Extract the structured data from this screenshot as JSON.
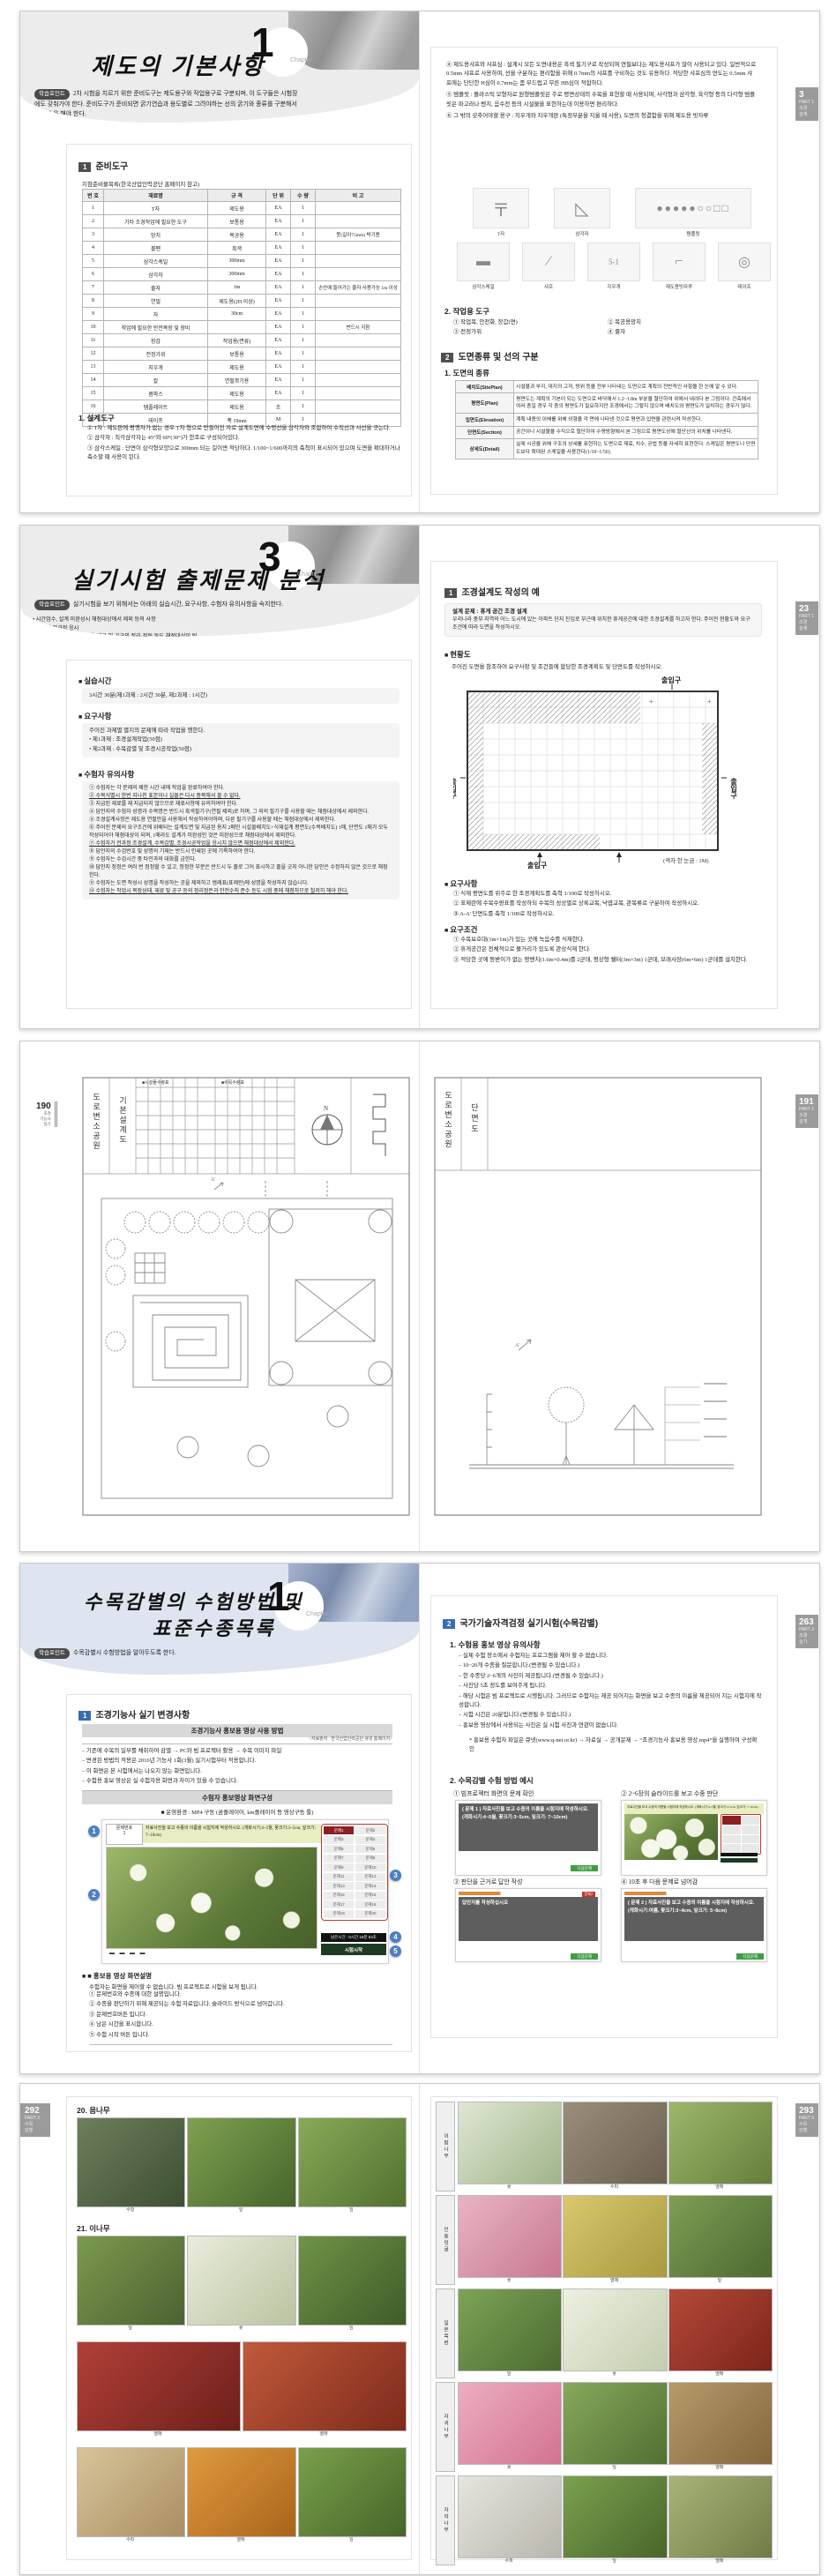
{
  "spread1": {
    "left": {
      "title": "제도의 기본사항",
      "chapter": "1",
      "chapter_word": "Chapter",
      "sp_label": "학습포인트",
      "sp_text": "2차 시험을 치르기 위한 준비도구는 제도용구와 작업용구로 구분되며, 이 도구들은 시험장에도 갖춰가야 한다. 준비도구가 준비되면 굵기연습과 용도별로 그려야하는 선의 굵기와 종류를 구분해서 선 연습을 해야 한다.",
      "sec_num": "1",
      "sec_title": "준비도구",
      "tbl_caption": "지참준비물목록(한국산업인력공단 홈페이지 참고)",
      "headers": [
        "번 호",
        "재료명",
        "규 격",
        "단 위",
        "수 량",
        "비 고"
      ],
      "rows": [
        [
          "1",
          "T자",
          "제도용",
          "EA",
          "1",
          ""
        ],
        [
          "2",
          "기타 조경작업에 필요한 도구",
          "보통용",
          "EA",
          "1",
          ""
        ],
        [
          "3",
          "망치",
          "목공용",
          "EA",
          "1",
          "못(길이75mm) 박기용"
        ],
        [
          "4",
          "볼펜",
          "흑색",
          "EA",
          "1",
          ""
        ],
        [
          "5",
          "삼각스케일",
          "300mm",
          "EA",
          "1",
          ""
        ],
        [
          "6",
          "삼각자",
          "300mm",
          "EA",
          "1",
          ""
        ],
        [
          "7",
          "줄자",
          "1m",
          "EA",
          "1",
          "손안에 들어가는 줄자 사용가능 1m 이상"
        ],
        [
          "8",
          "연필",
          "제도용(2H 이상)",
          "EA",
          "1",
          ""
        ],
        [
          "9",
          "자",
          "30cm",
          "EA",
          "1",
          ""
        ],
        [
          "10",
          "작업에 필요한 안전복장 및 장비",
          "",
          "EA",
          "1",
          "반드시 지참"
        ],
        [
          "11",
          "장갑",
          "작업용(면류)",
          "EA",
          "1",
          ""
        ],
        [
          "12",
          "전정가위",
          "보통용",
          "EA",
          "1",
          ""
        ],
        [
          "13",
          "지우개",
          "제도용",
          "EA",
          "1",
          ""
        ],
        [
          "14",
          "칼",
          "연필깎기용",
          "EA",
          "1",
          ""
        ],
        [
          "15",
          "콤파스",
          "제도용",
          "EA",
          "1",
          ""
        ],
        [
          "16",
          "템플레이트",
          "제도용",
          "조",
          "1",
          ""
        ],
        [
          "17",
          "테이프",
          "폭 19mm",
          "M",
          "1",
          ""
        ]
      ],
      "sub_title": "1. 설계도구",
      "notes": [
        "① T자 : 제도판에 평행자가 없는 경우 T자 형으로 만들어진 자로 설계도면에 수평선을 삼각자와 조합하여 수직선과 사선을 긋는다.",
        "② 삼각자 : 직각삼각자는 45°와 60°(30°)가 한조로 구성되어있다.",
        "③ 삼각스케일 : 단면이 삼각형모양으로 300mm 되는 길이면 적당하다. 1/100~1/600까지의 축척이 표시되어 있으며 도면을 확대하거나 축소할 때 사용이 된다."
      ]
    },
    "right": {
      "paras": [
        "④ 제도용샤프와 샤프심 : 설계시 모든 도면내용은 흑색 필기구로 작성되며 연필보다는 제도용샤프가 많이 사용되고 있다. 일반적으로 0.5mm 샤프로 사용하며, 선을 구분하는 편리함을 위해 0.7mm의 샤프를 구비하는 것도 유용하다. 적당한 샤프심의 연도는 0.5mm 샤프에는 단단한 H심이 0.7mm는 좀 부드럽고 무른 HB심이 적합하다.",
        "⑤ 템플릿 : 플라스틱 모형자로 원형템플릿은 주로 평면상태의 수목을 표현할 때 사용되며, 사각형과 삼각형, 육각형 등의 다각형 템플릿은 파고라나 벤치, 음수전 등의 시설물을 표현하는데 이용하면 편리하다.",
        "⑥ 그 밖의 갖추어야할 용구 : 지우개와 지우개판 (특정부분을 지울 때 사용), 도면의 청결함을 위해 제도용 빗자루"
      ],
      "tools_row1": [
        "T자",
        "삼각자",
        "템플릿"
      ],
      "tools_row2": [
        "삼각스케일",
        "샤프",
        "지우개",
        "제도용빗자루",
        "테이프"
      ],
      "work_title": "2. 작업용 도구",
      "work_items": [
        "① 작업복, 안전화, 장갑(면)",
        "② 목공용망치",
        "③ 전정가위",
        "④ 줄자"
      ],
      "sec2_num": "2",
      "sec2_title": "도면종류 및 선의 구분",
      "sub_title": "1. 도면의 종류",
      "def_rows": [
        [
          "배치도(SitePlan)",
          "시설물과 부지, 대지의 고저, 방위 등을 전부 나타내는 도면으로 계획의 전반적인 사항을 한 눈에 알 수 있다."
        ],
        [
          "평면도(Plan)",
          "평면도는 계획의 기본이 되는 도면으로 바닥에서 1.2~1.8m 부분을 절단하여 위에서 내려다 본 그림이다. 건축에서 여러 층일 경우 각 층의 평면도가 필요하지만 조경에서는 그렇지 않으며 배치도와 평면도가 일치하는 경우가 많다."
        ],
        [
          "입면도(Elevation)",
          "계획 내용의 이해를 위해 외형을 각 면에 나타낸 것으로 평면과 입면을 관련시켜 작성한다."
        ],
        [
          "단면도(Section)",
          "공간이나 시설물을 수직으로 절단하여 수평방향에서 본 그림으로 평면도상에 절단선의 위치를 나타낸다."
        ],
        [
          "상세도(Detail)",
          "실제 시공을 위해 구조의 상세를 표현하는 도면으로 재료, 치수, 공법 등을 자세히 표현한다. 스케일은 평면도나 단면도보다 확대된 스케일을 사용한다(1/10~1/50)."
        ]
      ],
      "tab": {
        "num": "3",
        "l1": "PART 1",
        "l2": "조경",
        "l3": "설계"
      }
    }
  },
  "spread2": {
    "left": {
      "title": "실기시험 출제문제 분석",
      "chapter": "3",
      "chapter_word": "Chapter",
      "sp_label": "학습포인트",
      "sp_text": "실기시험을 보기 위해서는 아래의 실습시간, 요구사항, 수험자 유의사항을 숙지한다.",
      "sp_bullets": [
        "시간엄수, 설계 미완성시 채점대상에서 제외 등의 사항",
        "시험의 전과정 응시",
        "수험자의 작업시 복장상태, 재료 및 공구의 정리·정돈 등도 채점대상이 됨"
      ],
      "h1": "실습시간",
      "box1": "3시간 30분(제1과제 : 2시간 30분, 제2과제 : 1시간)",
      "h2": "요구사항",
      "box2_intro": "주어진 과제별 별지의 문제에 따라 작업을 행한다.",
      "box2_items": [
        "제1과제 : 조경설계작업(50점)",
        "제2과제 : 수목감별 및 조경시공작업(50점)"
      ],
      "h3": "수험자 유의사항",
      "notices": [
        "① 수험자는 각 문제의 제한 시간 내에 작업을 완료하여야 한다.",
        "② 수목식별시 한번 지나친 표본이나 실물은 다시 중복해서 볼 수 없다.",
        "③ 지급된 재료를 재 지급되지 않으므로 재료사항에 유의하여야 한다.",
        "④ 답안지의 수험자 성명과 수목명은 반드시 흑색필기구(연필 제외)로 하며, 그 외의 필기구를 사용할 때는 채점대상에서 제외한다.",
        "⑤ 조경설계사항은 제도용 연필만을 사용해서 작성하여야하며, 다른 필기구를 사용할 때는 채점대상에서 제외한다.",
        "⑥ 주어진 문제의 요구조건에 위배되는 설계도면 및 지급된 용지 2매인 시설물배치도+식재설계 평면도(수목배치도) 1매, 단면도 1매가 모두 작성되어야 채점대상이 되며, 1매라도 설계가 미완성인 것은 미완성으로 채점대상에서 제외한다.",
        "⑦ 수험자가 전과정 조경설계, 수목감별, 조경시공작업을 응시치 않으면 채점대상에서 제외한다.",
        "⑧ 답안지의 수검번호 및 성명의 기재는 반드시 인쇄된 곳에 기록하여야 한다.",
        "⑨ 수험자는 수검시간 중 타인과의 대화를 금한다.",
        "⑩ 답안지 정정은 여러 번 정정할 수 있고, 정정한 부분은 반드시 두 줄로 그어 표시하고 줄을 긋지 아니한 답안은 수정하지 않은 것으로 채점한다.",
        "⑪ 수험자는 도면 작성시 성명을 작성하는 곳을 제외하고 범례표(표제란)에 성명을 작성하지 않습니다.",
        "⑫ 수험자는 작업시 복장상태, 재료 및 공구 등의 정리정돈과 안전수칙 준수 등도 시험 중에 채점하므로 철저히 해야 한다."
      ]
    },
    "right": {
      "sec_num": "1",
      "sec_title": "조경설계도 작성의 예",
      "prob_title": "설계 문제 : 휴게 공간 조경 설계",
      "prob_text": "우리나라 중부 지역의 어느 도시에 있는 아파트 단지 진입로 부근에 위치한 휴게공간에 대한 조경설계를 하고자 한다. 주어진 현황도와 요구조건에 따라 도면을 작성하시오.",
      "h_plan": "현황도",
      "plan_intro": "주어진 도면을 참조하여 요구사항 및 조건들에 합당한 조경계획도 및 단면도를 작성하시오.",
      "entrance": "출입구",
      "grid_note": "(격자 한 눈금 : 1M)",
      "h_req": "요구사항",
      "reqs": [
        "① 식재 평면도를 위주로 한 조경계획도를 축척 1/100로 작성하시오.",
        "② 표제란에 수목수량표를 작성하되 수목의 성상별로 상록교목, 낙엽교목, 관목류로 구분하여 작성하시오.",
        "③ A-A' 단면도를 축척 1/100로 작성하시오."
      ],
      "h_cond": "요구조건",
      "conds": [
        "① 수목보호대(1m×1m)가 있는 곳에 녹음수를 식재한다.",
        "② 휴게공간은 전체적으로 볼거리가 있도록 관상식재 한다.",
        "③ 적당한 곳에 등받이가 없는 평벤치(1.6m×0.4m)를 2군데, 평상형 쉘터(3m×3m) 1군데, 모래사장(6m×6m) 1군데를 설치한다."
      ],
      "tab": {
        "num": "23",
        "l1": "PART 1",
        "l2": "조경",
        "l3": "설계"
      }
    }
  },
  "spread3": {
    "left": {
      "pageno": "190",
      "margin": [
        "조경",
        "기능사",
        "실기"
      ],
      "tb1": "도로변소공원",
      "tb2": "기본설계도",
      "leg1": "시설물수량표",
      "leg2": "수목수량표",
      "north": "N"
    },
    "right": {
      "tb1": "도로변소공원",
      "tb2": "단면도",
      "tab": {
        "num": "191",
        "l1": "PART 1",
        "l2": "조경",
        "l3": "설계"
      }
    }
  },
  "spread4": {
    "left": {
      "title1": "수목감별의 수험방법 및",
      "title2": "표준수종목록",
      "chapter": "1",
      "chapter_word": "Chapter",
      "sp_label": "학습포인트",
      "sp_text": "수목감별시 수험방법을 알아두도록 한다.",
      "sec_num": "1",
      "sec_title": "조경기능사 실기 변경사항",
      "bar1": "조경기능사 홍보용 영상 사용 방법",
      "src": "<자료출처 : 한국산업인력공단 큐넷 홈페이지>",
      "dashes": [
        "– 기존에 수목의 일부를 채취하여 감별 → PC와 빔 프로젝터 활용 → 수목 이미지 파일",
        "– 변경된 방법의 적용은 2016년 기능사 1회(3월) 실기시험부터 적용합니다.",
        "– 이 화면은 본 시험에서는 나오지 않는 화면입니다.",
        "– 수험용 홍보 영상은 실 수험자용 화면과 차이가 있을 수 있습니다."
      ],
      "bar2": "수험자 홍보영상 화면구성",
      "env": "■ 운영환경 : MP4 구동 (곰플레이어, km플레이어 등 영상구동 툴)",
      "player": {
        "qlabel": "문제번호",
        "qnum": "1",
        "inst": "자료사진을 보고 수종의 이름을 시험지에 작성하시오. (개화시기:4~5월, 꽃크기:3~5cm, 잎크기: 7~10cm)",
        "buttons": [
          "문제1",
          "문제2",
          "문제3",
          "문제4",
          "문제5",
          "문제6",
          "문제7",
          "문제8",
          "문제9",
          "문제10",
          "문제11",
          "문제12",
          "문제13",
          "문제14",
          "문제15",
          "문제16",
          "문제17",
          "문제18",
          "문제19",
          "문제20"
        ],
        "timer": "남은시간 : 0시간 19분 53초",
        "start": "시험시작",
        "callouts": [
          "1",
          "2",
          "3",
          "4",
          "5"
        ]
      },
      "h_desc": "■ 홍보용 영상 화면설명",
      "desc_intro": "수험자는 화면을 제어할 수 없습니다. 빔 프로젝트로 시험을 보게 됩니다.",
      "descs": [
        "① 문제번호와 수종에 대한 설명입니다.",
        "② 수종을 판단하기 위해 제공되는 수험 자료입니다. 슬라이드 방식으로 넘어갑니다.",
        "③ 문제번호버튼 입니다.",
        "④ 남은 시간을 표시합니다.",
        "⑤ 수험 시작 버튼 입니다."
      ]
    },
    "right": {
      "sec_num": "2",
      "sec_title": "국가기술자격검정 실기시험(수목감별)",
      "h1": "1. 수험용 홍보 영상 유의사항",
      "dashes": [
        "– 실제 수험 장소에서 수험자는 프로그램을 제어 할 수 없습니다.",
        "– 10~20개 수종을 질문합니다.(변경될 수 있습니다.)",
        "– 한 수종당 2~6개의 사진이 제공됩니다.(변경될 수 있습니다.)",
        "– 사진당 5초 정도를 보여주게 됩니다.",
        "– 해당 시험은 빔 프로젝트로 시행됩니다. 그러므로 수험자는 제공 되어지는 화면을 보고 수종의 이름을 제공되어 지는 시험지에 작성합니다.",
        "– 시험 시간은 20분입니다.(변경될 수 있습니다.)",
        "– 홍보용 영상에서 사용되는 사진은 실 시험 사진과 연관이 없습니다."
      ],
      "note": "* 홍보용 수험자 파일은 큐넷(www.q-net.or.kr) → 자료실 → 공개문제 → “조경기능사 홍보용 영상.mp4”을 실행하여 구성확인",
      "h2": "2. 수목감별 수험 방법 예시",
      "ex1_cap": "① 빔프로젝터 화면의 문제 확인",
      "ex1_text": "( 문제 1 ) 자료사진을 보고 수종의 이름을 시험지에 작성하시오. (개화시기:4~5월, 꽃크기:3~5cm, 잎크기: 7~10cm)",
      "ex2_cap": "② 2~6장의 슬라이드를 보고 수종 판단",
      "ex3_cap": "③ 판단을 근거로 답안 작성",
      "ex3_text": "답안지를 작성하십시오",
      "ex3_badge": "문제2",
      "ex4_cap": "④ 10초 후 다음 문제로 넘어감",
      "ex4_text": "( 문제 2 ) 자료사진을 보고 수종의 이름을 시험지에 작성하시오. (개화시기:여름, 꽃크기:3~4cm, 잎크기: 5~8cm)",
      "btn": "다음문제",
      "tab": {
        "num": "263",
        "l1": "PART 3",
        "l2": "조경",
        "l3": "실기"
      }
    }
  },
  "spread5": {
    "left": {
      "tab": {
        "num": "292",
        "l1": "PART 3",
        "l2": "수목",
        "l3": "감별"
      },
      "sec20": {
        "no": "20.",
        "name": "음나무",
        "photos": [
          {
            "c1": "#6d7f5c",
            "c2": "#3e4f33",
            "cap": "수형"
          },
          {
            "c1": "#7fa050",
            "c2": "#46662c",
            "cap": "잎"
          },
          {
            "c1": "#88aa58",
            "c2": "#52702f",
            "cap": "잎"
          }
        ]
      },
      "sec21": {
        "no": "21.",
        "name": "이나무",
        "rows": [
          [
            {
              "c1": "#7c9a4e",
              "c2": "#4a6330",
              "cap": "잎"
            },
            {
              "c1": "#e9ecdc",
              "c2": "#b9c4a0",
              "cap": "꽃"
            },
            {
              "c1": "#6f9347",
              "c2": "#3f5c28",
              "cap": "잎"
            }
          ],
          [
            {
              "c1": "#b04038",
              "c2": "#6e1f1a",
              "cap": "열매"
            },
            {
              "c1": "#c05a3a",
              "c2": "#7e2a1c",
              "cap": "열매"
            }
          ],
          [
            {
              "c1": "#d8c49a",
              "c2": "#a98f62",
              "cap": "수피"
            },
            {
              "c1": "#e09a3e",
              "c2": "#aa641c",
              "cap": "열매"
            },
            {
              "c1": "#79a04a",
              "c2": "#47652a",
              "cap": "잎"
            }
          ]
        ]
      }
    },
    "right": {
      "tab": {
        "num": "293",
        "l1": "PART 3",
        "l2": "수목",
        "l3": "감별"
      },
      "rows": [
        {
          "name": "이팝나무",
          "photos": [
            {
              "c1": "#dfe7d4",
              "c2": "#9fb488",
              "cap": "꽃"
            },
            {
              "c1": "#9a8d7c",
              "c2": "#6b604f",
              "cap": "수피"
            },
            {
              "c1": "#9cb86a",
              "c2": "#657f3c",
              "cap": "열매"
            }
          ]
        },
        {
          "name": "인동덩굴",
          "photos": [
            {
              "c1": "#e8b4c4",
              "c2": "#c87890",
              "cap": "꽃"
            },
            {
              "c1": "#d9c86e",
              "c2": "#a89a3e",
              "cap": "열매"
            },
            {
              "c1": "#7f9e54",
              "c2": "#4c6930",
              "cap": "잎"
            }
          ]
        },
        {
          "name": "일본목련",
          "photos": [
            {
              "c1": "#7da457",
              "c2": "#4a6a2f",
              "cap": "잎"
            },
            {
              "c1": "#eef0e2",
              "c2": "#c3cdae",
              "cap": "꽃"
            },
            {
              "c1": "#b44a38",
              "c2": "#7c241a",
              "cap": "열매"
            }
          ]
        },
        {
          "name": "자귀나무",
          "photos": [
            {
              "c1": "#ecaec2",
              "c2": "#d3738f",
              "cap": "꽃"
            },
            {
              "c1": "#86a85c",
              "c2": "#527032",
              "cap": "잎"
            },
            {
              "c1": "#b69a6a",
              "c2": "#84683c",
              "cap": "열매"
            }
          ]
        },
        {
          "name": "자작나무",
          "photos": [
            {
              "c1": "#e6e4de",
              "c2": "#b9b6ac",
              "cap": "수피"
            },
            {
              "c1": "#7ba04e",
              "c2": "#48662b",
              "cap": "잎"
            },
            {
              "c1": "#a8b478",
              "c2": "#6f7c46",
              "cap": "열매"
            }
          ]
        }
      ]
    }
  }
}
